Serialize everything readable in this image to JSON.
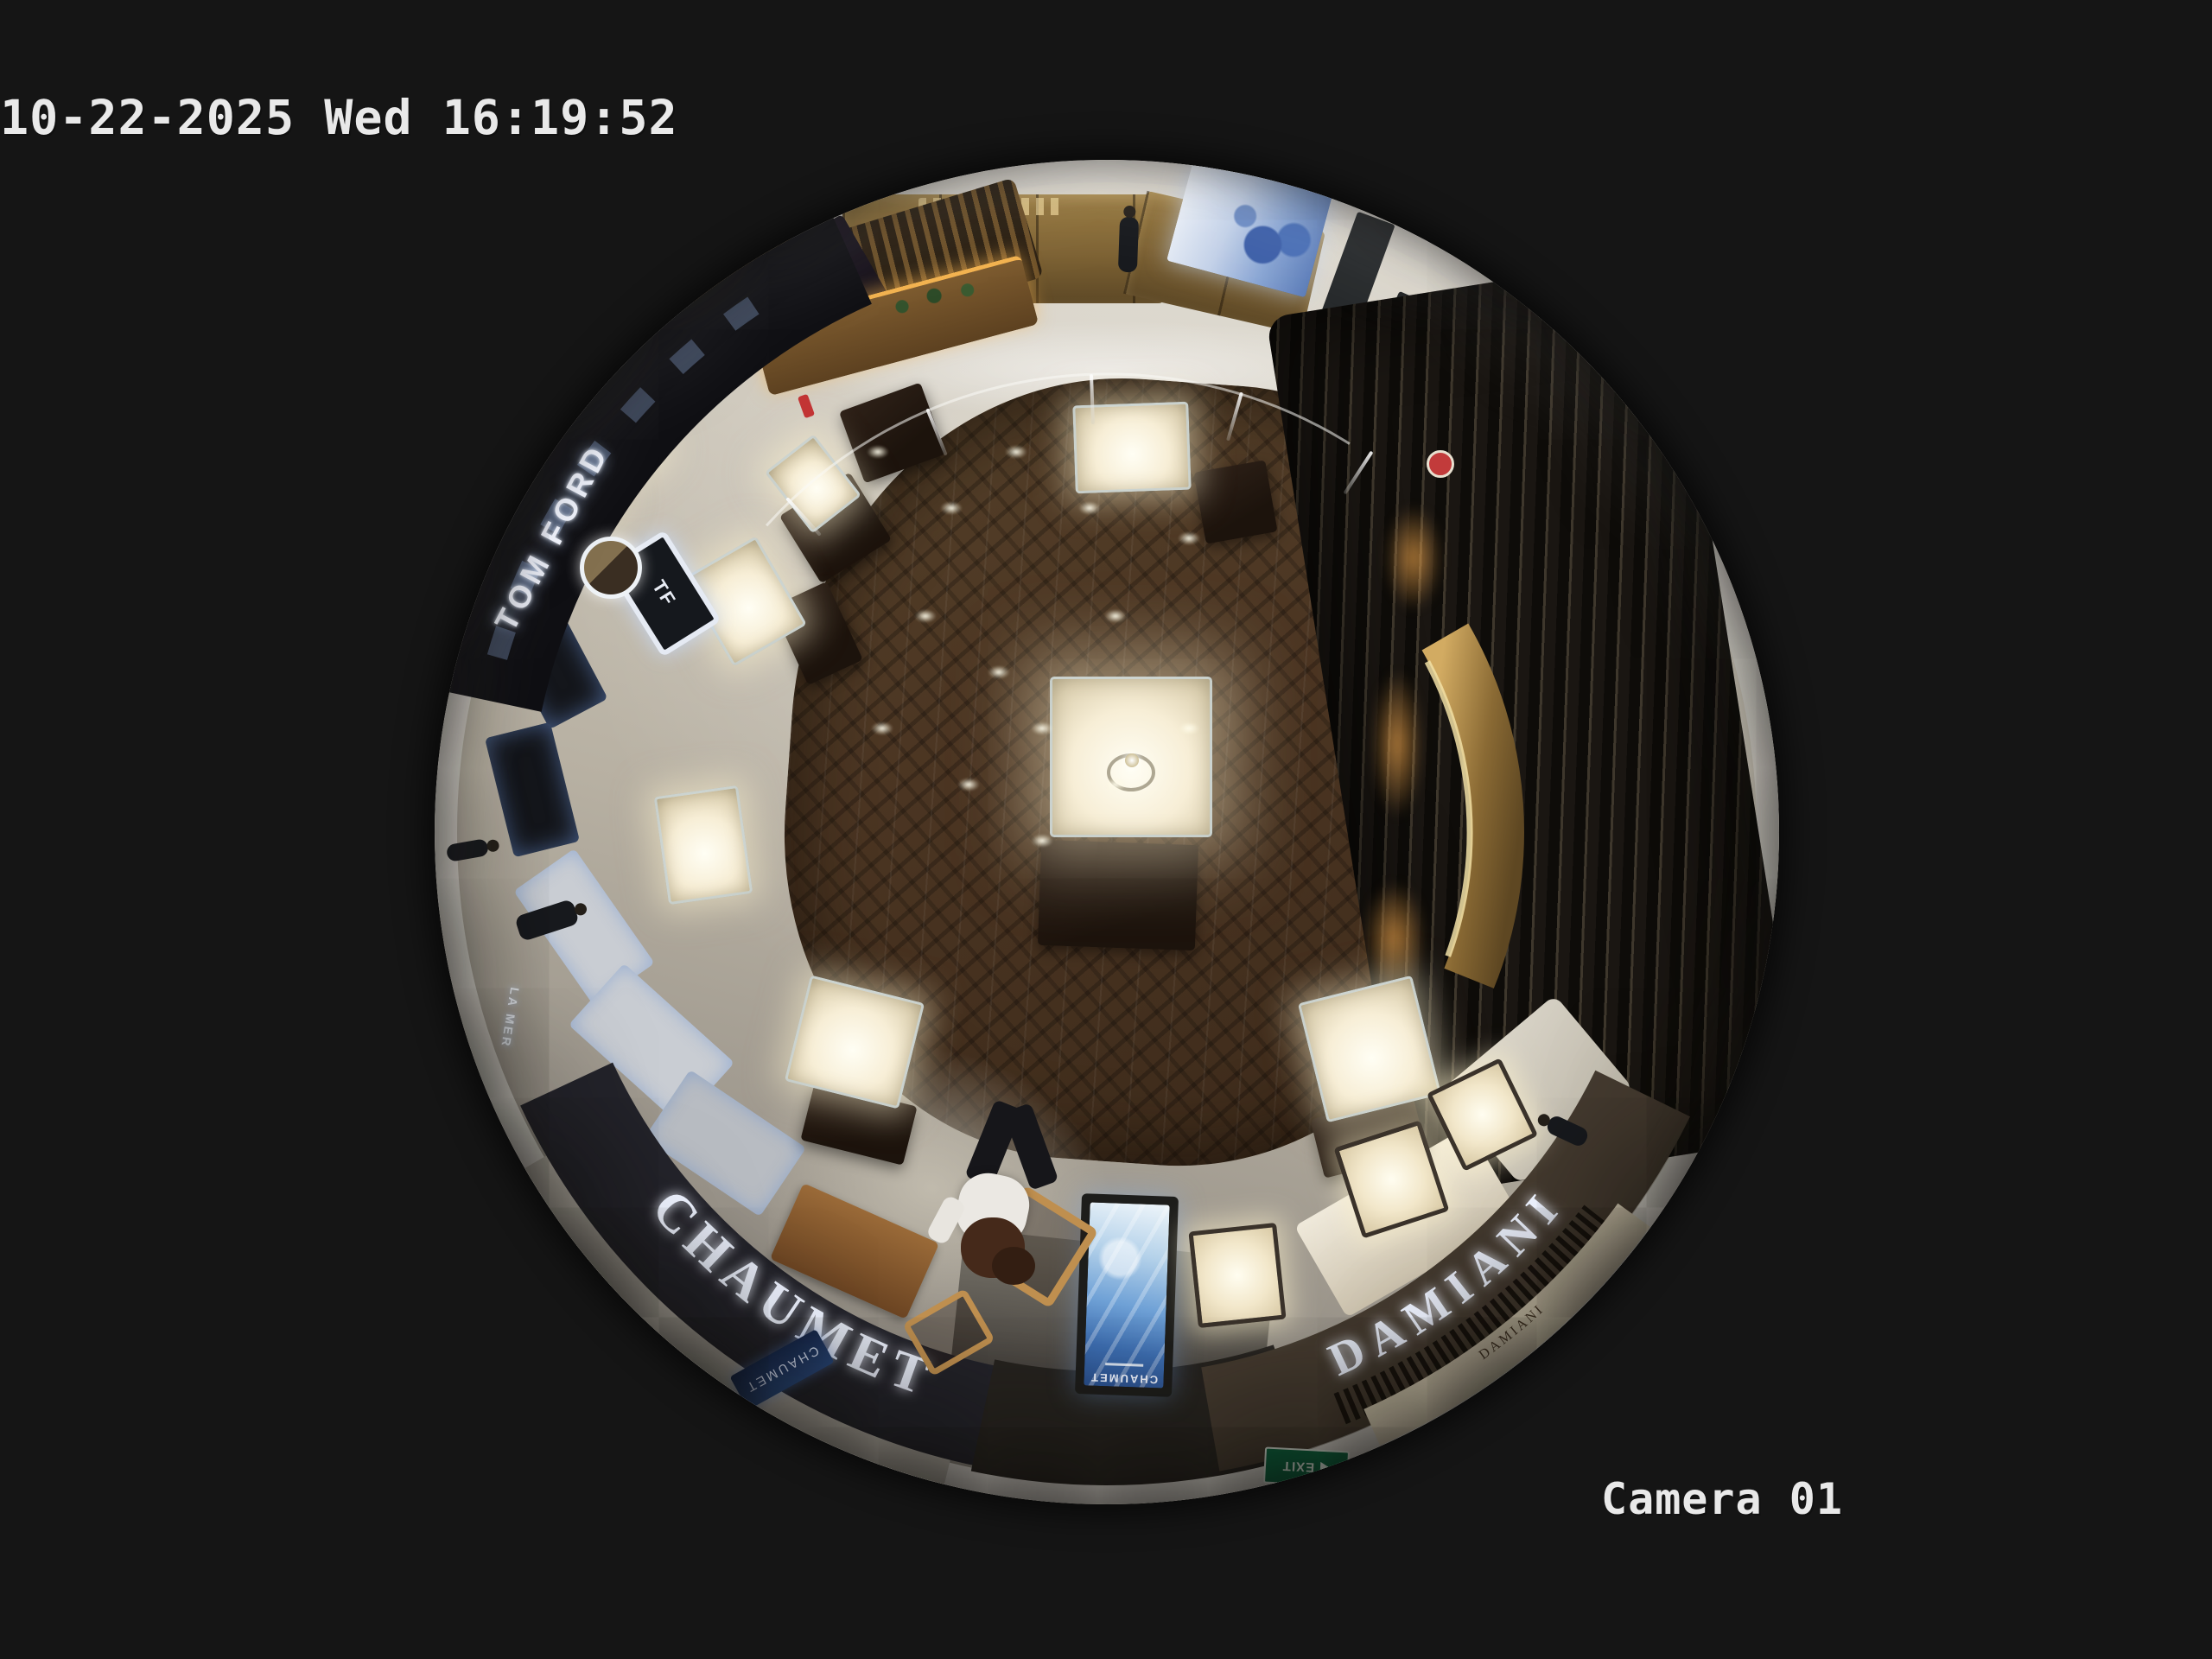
{
  "osd": {
    "timestamp": "10-22-2025 Wed 16:19:52",
    "camera_label": "Camera 01"
  },
  "scene": {
    "signs": {
      "tom_ford": "TOM FORD",
      "tf_monogram": "TF",
      "chaumet_fascia": "CHAUMET",
      "chaumet_boutique_small": "CHAUMET",
      "chaumet_totem": "CHAUMET",
      "damiani_fascia": "DAMIANI",
      "damiani_small": "DAMIANI",
      "la_mer": "LA MER",
      "exit": "EXIT"
    },
    "colors": {
      "background": "#151515",
      "osd_text": "#e9e9e9",
      "sign_glow_white": "#e8f0ff",
      "exit_green": "#0c6a42",
      "wood_floor": "#4a3522",
      "marble": "#c9c3b6",
      "brass_wall": "#8a6f3e",
      "totem_screen_blue": "#4f7fc0"
    }
  }
}
